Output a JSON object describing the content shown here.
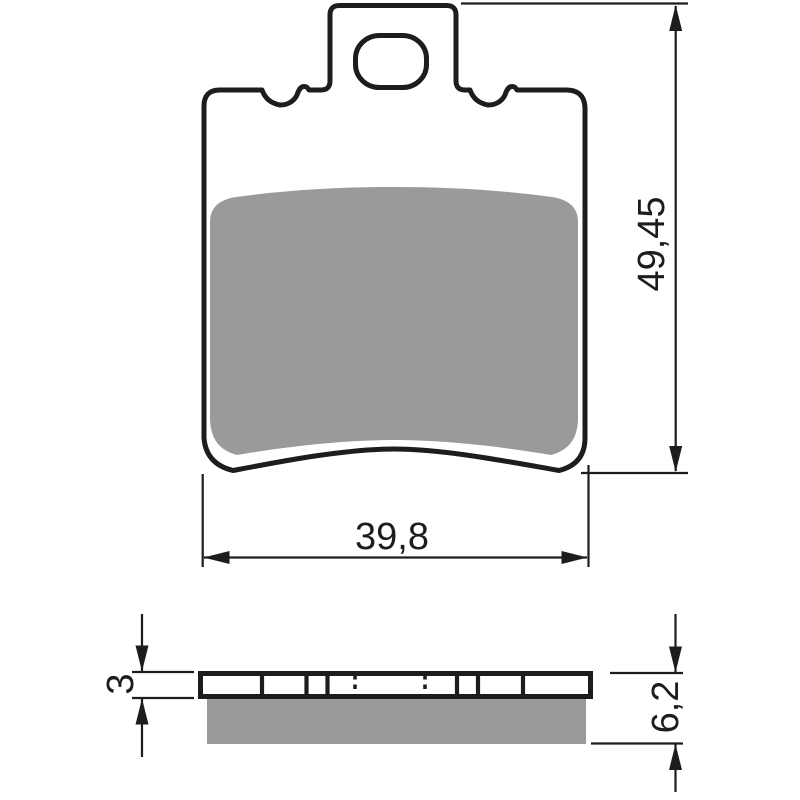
{
  "drawing": {
    "dimensions": {
      "pad_height": "49,45",
      "pad_width": "39,8",
      "backplate_thickness": "3",
      "total_thickness": "6,2"
    },
    "colors": {
      "outline": "#1d1d1b",
      "friction_material": "#9a9a9a",
      "background": "#ffffff"
    }
  }
}
